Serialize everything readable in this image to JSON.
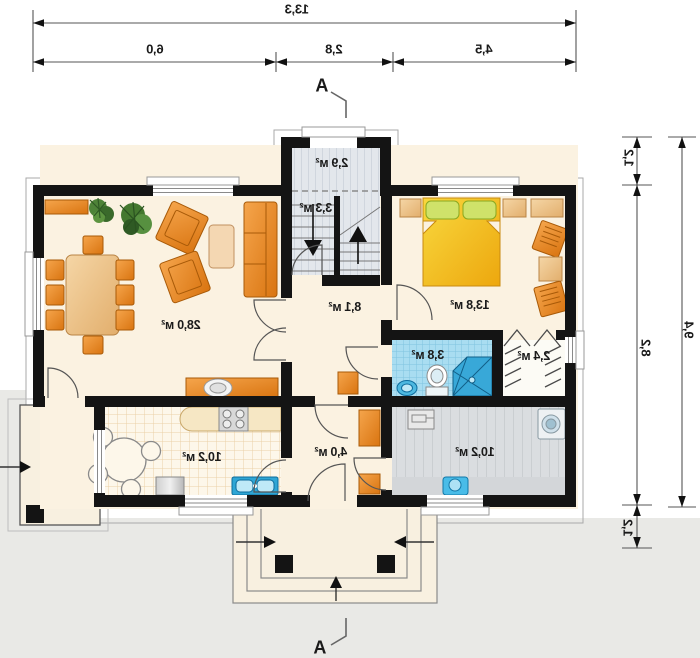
{
  "dimensions": {
    "top_total": "13,3",
    "top_seg_1": "6,0",
    "top_seg_2": "2,8",
    "top_seg_3": "4,5",
    "right_total": "9,4",
    "right_seg_1": "1,2",
    "right_seg_2": "8,2",
    "right_seg_3": "1,2"
  },
  "section_marker": "A",
  "rooms": {
    "living": "28,0 м²",
    "vestibule": "2,9 м²",
    "stairs": "3,3 м²",
    "hallway": "8,1 м²",
    "bedroom": "13,8 м²",
    "bathroom": "3,8 м²",
    "wardrobe": "2,4 м²",
    "kitchen": "10,2 м²",
    "hall": "4,0 м²",
    "utility": "10,2 м²"
  },
  "colors": {
    "wall": "#141414",
    "floor_cream": "#fbf2e1",
    "furniture_orange": "#e8882a",
    "bed_yellow": "#f2c21e",
    "tile_blue": "#a9ddf1",
    "floor_gray": "#e2e6ea",
    "background_gray": "#e9e9e6"
  }
}
